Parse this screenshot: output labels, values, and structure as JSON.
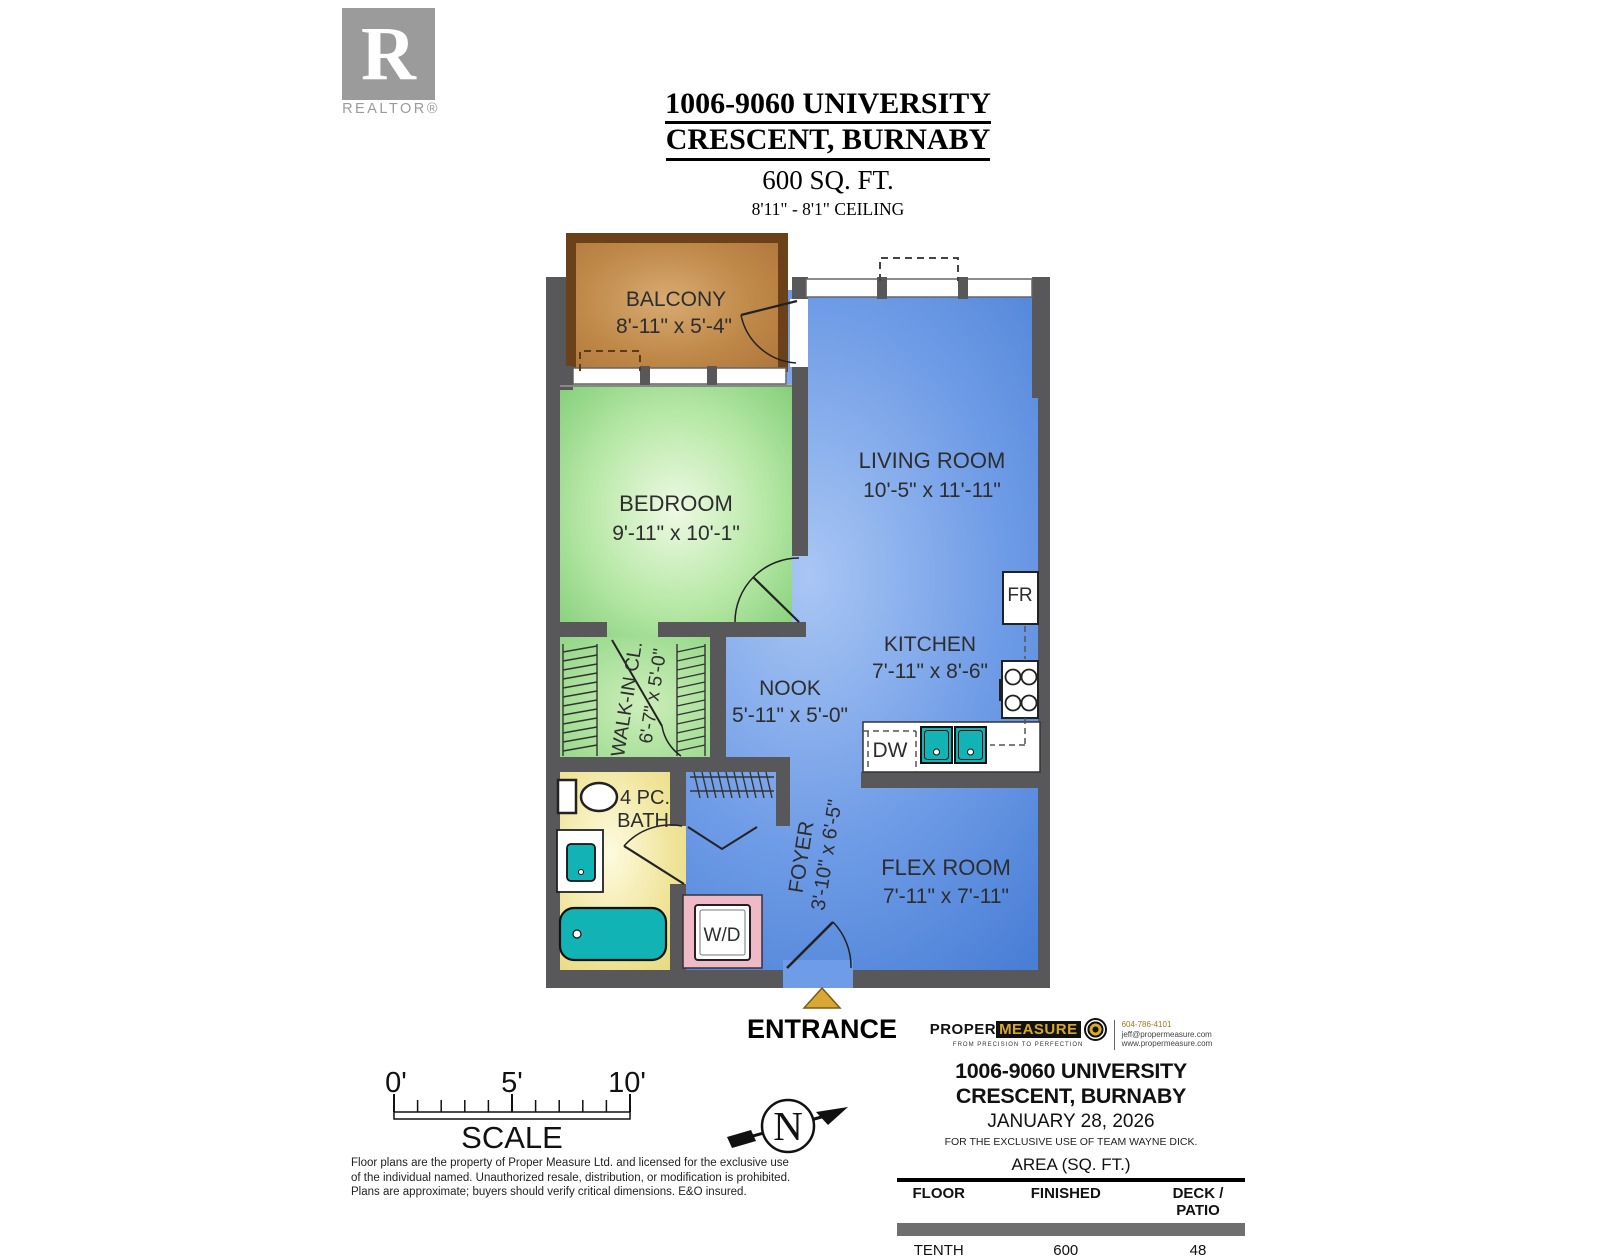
{
  "header": {
    "realtor_letter": "R",
    "realtor_label": "REALTOR®",
    "title_line1": "1006-9060 UNIVERSITY",
    "title_line2": "CRESCENT, BURNABY",
    "area": "600 SQ. FT.",
    "ceiling": "8'11\" - 8'1\" CEILING"
  },
  "plan": {
    "rooms": {
      "balcony": {
        "name": "BALCONY",
        "dims": "8'-11\" x 5'-4\""
      },
      "living": {
        "name": "LIVING ROOM",
        "dims": "10'-5\" x 11'-11\""
      },
      "bedroom": {
        "name": "BEDROOM",
        "dims": "9'-11\" x 10'-1\""
      },
      "kitchen": {
        "name": "KITCHEN",
        "dims": "7'-11\" x 8'-6\""
      },
      "nook": {
        "name": "NOOK",
        "dims": "5'-11\" x 5'-0\""
      },
      "wic": {
        "name": "WALK-IN CL.",
        "dims": "6'-7\" x 5'-0\""
      },
      "bath": {
        "name_line1": "4 PC.",
        "name_line2": "BATH"
      },
      "foyer": {
        "name": "FOYER",
        "dims": "3'-10\" x 6'-5\""
      },
      "flex": {
        "name": "FLEX ROOM",
        "dims": "7'-11\" x 7'-11\""
      }
    },
    "labels": {
      "fridge": "FR",
      "dishwasher": "DW",
      "washer_dryer": "W/D",
      "entrance": "ENTRANCE",
      "north": "N"
    }
  },
  "scalebar": {
    "tick0": "0'",
    "tick5": "5'",
    "tick10": "10'",
    "label": "SCALE"
  },
  "disclaimer": {
    "line1": "Floor plans are the property of Proper Measure Ltd. and licensed for the exclusive use",
    "line2": "of the individual named. Unauthorized resale, distribution, or modification is prohibited.",
    "line3": "Plans are approximate; buyers should verify critical dimensions. E&O insured."
  },
  "footer": {
    "logo": {
      "word1": "PROPER",
      "word2": "MEASURE",
      "tagline": "FROM PRECISION TO PERFECTION",
      "phone": "604-786-4101",
      "email": "jeff@propermeasure.com",
      "website": "www.propermeasure.com"
    },
    "address": "1006-9060 UNIVERSITY CRESCENT, BURNABY",
    "date": "JANUARY 28, 2026",
    "exclusive": "FOR THE EXCLUSIVE USE OF TEAM WAYNE DICK.",
    "table": {
      "title": "AREA (SQ. FT.)",
      "headers": [
        "FLOOR",
        "FINISHED",
        "DECK / PATIO"
      ],
      "rows": [
        [
          "TENTH",
          "600",
          "48"
        ]
      ]
    }
  },
  "colors": {
    "wall": "#58585a",
    "living_blue": "#6f9ce6",
    "bedroom_green": "#9ddb90",
    "bath_yellow": "#f0e49a",
    "balcony_brown": "#c08a4a",
    "balcony_border": "#6b4119",
    "fixture_teal": "#12b3b5",
    "wd_pink": "#efb9c6",
    "entrance_gold": "#d9a733",
    "logo_gray": "#9b9b9b",
    "brand_gold": "#d8a826"
  }
}
